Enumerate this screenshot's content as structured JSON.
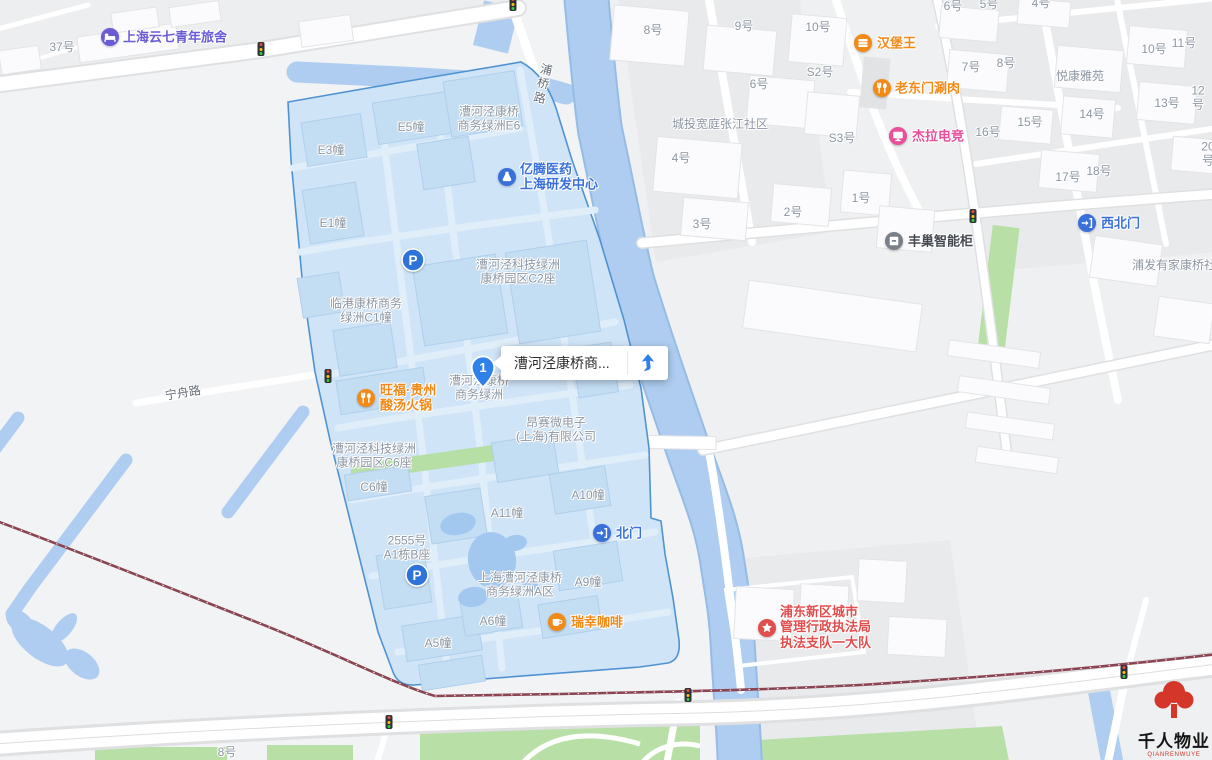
{
  "map": {
    "selected_place": {
      "marker_number": "1",
      "label": "漕河泾康桥商...",
      "nav_icon": "route-arrow-icon"
    },
    "logo": {
      "title": "千人物业",
      "latin": "QIANRENWUYE"
    },
    "colors": {
      "zone_fill": "#cfe4f7",
      "zone_border": "#4f93d2",
      "water": "#aecdf0",
      "green": "#b7dfa6",
      "railway": "#8a4452",
      "poi_orange": "#f28a19",
      "poi_blue": "#3a70d9",
      "poi_purple": "#6a5cd5",
      "poi_pink": "#ea4f9b",
      "poi_red": "#e14e4e",
      "poi_dark": "#454a52",
      "label_gray": "#8d96a3"
    },
    "labels": [
      {
        "text": "37号",
        "x": 62,
        "y": 47
      },
      {
        "text": "漕河泾康桥\n商务绿洲E6",
        "x": 489,
        "y": 119
      },
      {
        "text": "E5幢",
        "x": 411,
        "y": 127
      },
      {
        "text": "E3幢",
        "x": 331,
        "y": 150
      },
      {
        "text": "E1幢",
        "x": 333,
        "y": 223
      },
      {
        "text": "漕河泾科技绿洲\n康桥园区C2座",
        "x": 518,
        "y": 272
      },
      {
        "text": "临港康桥商务\n绿洲C1幢",
        "x": 366,
        "y": 311
      },
      {
        "text": "漕河泾康桥\n商务绿洲",
        "x": 479,
        "y": 388
      },
      {
        "text": "昂赛微电子\n(上海)有限公司",
        "x": 556,
        "y": 430
      },
      {
        "text": "漕河泾科技绿洲\n康桥园区C6座",
        "x": 374,
        "y": 456
      },
      {
        "text": "C6幢",
        "x": 374,
        "y": 487
      },
      {
        "text": "A10幢",
        "x": 588,
        "y": 495
      },
      {
        "text": "A11幢",
        "x": 507,
        "y": 513
      },
      {
        "text": "2555号\nA1栋B座",
        "x": 407,
        "y": 548
      },
      {
        "text": "上海漕河泾康桥\n商务绿洲A区",
        "x": 520,
        "y": 585
      },
      {
        "text": "A9幢",
        "x": 588,
        "y": 582
      },
      {
        "text": "A6幢",
        "x": 493,
        "y": 621
      },
      {
        "text": "A5幢",
        "x": 438,
        "y": 643
      },
      {
        "text": "宁舟路",
        "x": 183,
        "y": 393,
        "rot": -9,
        "color": "#666d78",
        "name": "road-label-ningzhoulu"
      },
      {
        "text": "浦\n桥\n路",
        "x": 543,
        "y": 84,
        "rot": 13,
        "color": "#666d78",
        "name": "road-label-puqiaolu"
      },
      {
        "text": "8号",
        "x": 653,
        "y": 30
      },
      {
        "text": "9号",
        "x": 744,
        "y": 26
      },
      {
        "text": "10号",
        "x": 818,
        "y": 27
      },
      {
        "text": "S2号",
        "x": 820,
        "y": 72
      },
      {
        "text": "6号",
        "x": 759,
        "y": 84
      },
      {
        "text": "城投宽庭张江社区",
        "x": 720,
        "y": 124
      },
      {
        "text": "S3号",
        "x": 842,
        "y": 138
      },
      {
        "text": "4号",
        "x": 681,
        "y": 158
      },
      {
        "text": "1号",
        "x": 861,
        "y": 198
      },
      {
        "text": "2号",
        "x": 793,
        "y": 212
      },
      {
        "text": "3号",
        "x": 702,
        "y": 224
      },
      {
        "text": "6号",
        "x": 953,
        "y": 6
      },
      {
        "text": "5号",
        "x": 989,
        "y": 4
      },
      {
        "text": "4号",
        "x": 1041,
        "y": 3
      },
      {
        "text": "7号",
        "x": 971,
        "y": 67
      },
      {
        "text": "8号",
        "x": 1006,
        "y": 63
      },
      {
        "text": "悦康雅苑",
        "x": 1080,
        "y": 76
      },
      {
        "text": "10号",
        "x": 1154,
        "y": 49
      },
      {
        "text": "11号",
        "x": 1184,
        "y": 43
      },
      {
        "text": "13号",
        "x": 1167,
        "y": 103
      },
      {
        "text": "12号",
        "x": 1198,
        "y": 98
      },
      {
        "text": "14号",
        "x": 1092,
        "y": 114
      },
      {
        "text": "15号",
        "x": 1030,
        "y": 122
      },
      {
        "text": "16号",
        "x": 988,
        "y": 132
      },
      {
        "text": "17号",
        "x": 1068,
        "y": 177
      },
      {
        "text": "18号",
        "x": 1099,
        "y": 171
      },
      {
        "text": "20号",
        "x": 1208,
        "y": 154
      },
      {
        "text": "浦发有家康桥社区",
        "x": 1132,
        "y": 265,
        "align": "left"
      },
      {
        "text": "8号",
        "x": 227,
        "y": 752
      }
    ],
    "pois": [
      {
        "name": "poi-hostel",
        "icon": "bed",
        "x": 110,
        "y": 37,
        "text": "上海云七青年旅舍",
        "tx": 123,
        "ty": 37,
        "color": "#6a5cd5"
      },
      {
        "name": "poi-yiteng-pharma",
        "icon": "flask",
        "x": 507,
        "y": 177,
        "text": "亿腾医药\n上海研发中心",
        "tx": 520,
        "ty": 177,
        "color": "#3a70d9"
      },
      {
        "name": "poi-wangfu-hotpot",
        "icon": "food",
        "x": 366,
        "y": 398,
        "text": "旺福·贵州\n酸汤火锅",
        "tx": 380,
        "ty": 398,
        "color": "#f28a19"
      },
      {
        "name": "poi-burger-king",
        "icon": "burger",
        "x": 863,
        "y": 43,
        "text": "汉堡王",
        "tx": 877,
        "ty": 43,
        "color": "#f28a19"
      },
      {
        "name": "poi-laodongmen",
        "icon": "food",
        "x": 882,
        "y": 88,
        "text": "老东门涮肉",
        "tx": 895,
        "ty": 88,
        "color": "#f28a19"
      },
      {
        "name": "poi-jiela-esports",
        "icon": "monitor",
        "x": 898,
        "y": 136,
        "text": "杰拉电竞",
        "tx": 912,
        "ty": 136,
        "color": "#ea4f9b"
      },
      {
        "name": "poi-fengchao-locker",
        "icon": "locker",
        "x": 894,
        "y": 241,
        "text": "丰巢智能柜",
        "tx": 908,
        "ty": 241,
        "color": "#454a52",
        "icon_color": "#7a8089"
      },
      {
        "name": "poi-northwest-gate",
        "icon": "gate",
        "x": 1087,
        "y": 223,
        "text": "西北门",
        "tx": 1101,
        "ty": 223,
        "color": "#3a70d9"
      },
      {
        "name": "poi-north-gate",
        "icon": "gate",
        "x": 602,
        "y": 533,
        "text": "北门",
        "tx": 616,
        "ty": 533,
        "color": "#3a70d9"
      },
      {
        "name": "poi-luckin-coffee",
        "icon": "coffee",
        "x": 557,
        "y": 622,
        "text": "瑞幸咖啡",
        "tx": 571,
        "ty": 622,
        "color": "#f28a19"
      },
      {
        "name": "poi-law-enforcement",
        "icon": "star",
        "x": 767,
        "y": 628,
        "text": "浦东新区城市\n管理行政执法局\n执法支队一大队",
        "tx": 780,
        "ty": 627,
        "color": "#e14e4e"
      },
      {
        "name": "parking-icon-north",
        "icon": "parking",
        "x": 413,
        "y": 260,
        "text": "",
        "color": "#2e73d8"
      },
      {
        "name": "parking-icon-south",
        "icon": "parking",
        "x": 417,
        "y": 575,
        "text": "",
        "color": "#2e73d8"
      }
    ],
    "traffic_lights": [
      {
        "x": 261,
        "y": 49
      },
      {
        "x": 513,
        "y": 4
      },
      {
        "x": 328,
        "y": 376
      },
      {
        "x": 973,
        "y": 216
      },
      {
        "x": 688,
        "y": 695
      },
      {
        "x": 389,
        "y": 722
      },
      {
        "x": 1124,
        "y": 672
      }
    ]
  }
}
